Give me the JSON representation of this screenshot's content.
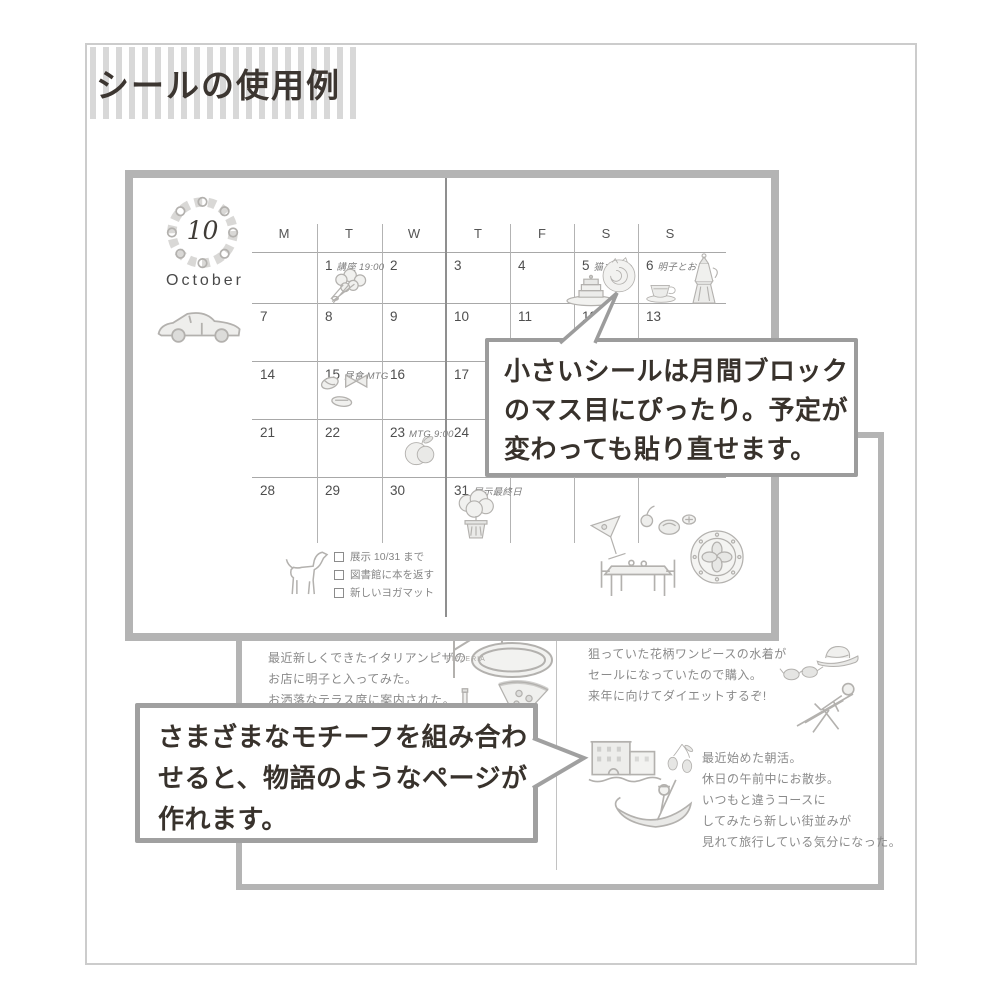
{
  "header": {
    "title": "シールの使用例"
  },
  "calendar": {
    "month_number": "10",
    "month_name": "October",
    "weekdays": [
      "M",
      "T",
      "W",
      "T",
      "F",
      "S",
      "S"
    ],
    "cells": [
      {
        "row": 0,
        "col": 1,
        "num": "1",
        "note": "講座 19:00"
      },
      {
        "row": 0,
        "col": 2,
        "num": "2",
        "note": ""
      },
      {
        "row": 0,
        "col": 3,
        "num": "3",
        "note": ""
      },
      {
        "row": 0,
        "col": 4,
        "num": "4",
        "note": ""
      },
      {
        "row": 0,
        "col": 5,
        "num": "5",
        "note": "猫カフェ"
      },
      {
        "row": 0,
        "col": 6,
        "num": "6",
        "note": "明子とお茶"
      },
      {
        "row": 1,
        "col": 0,
        "num": "7",
        "note": ""
      },
      {
        "row": 1,
        "col": 1,
        "num": "8",
        "note": ""
      },
      {
        "row": 1,
        "col": 2,
        "num": "9",
        "note": ""
      },
      {
        "row": 1,
        "col": 3,
        "num": "10",
        "note": ""
      },
      {
        "row": 1,
        "col": 4,
        "num": "11",
        "note": ""
      },
      {
        "row": 1,
        "col": 5,
        "num": "12",
        "note": ""
      },
      {
        "row": 1,
        "col": 6,
        "num": "13",
        "note": ""
      },
      {
        "row": 2,
        "col": 0,
        "num": "14",
        "note": ""
      },
      {
        "row": 2,
        "col": 1,
        "num": "15",
        "note": "昼食 MTG"
      },
      {
        "row": 2,
        "col": 2,
        "num": "16",
        "note": ""
      },
      {
        "row": 2,
        "col": 3,
        "num": "17",
        "note": ""
      },
      {
        "row": 2,
        "col": 4,
        "num": "18",
        "note": ""
      },
      {
        "row": 2,
        "col": 5,
        "num": "19",
        "note": ""
      },
      {
        "row": 2,
        "col": 6,
        "num": "20",
        "note": ""
      },
      {
        "row": 3,
        "col": 0,
        "num": "21",
        "note": ""
      },
      {
        "row": 3,
        "col": 1,
        "num": "22",
        "note": ""
      },
      {
        "row": 3,
        "col": 2,
        "num": "23",
        "note": "MTG 9:00"
      },
      {
        "row": 3,
        "col": 3,
        "num": "24",
        "note": ""
      },
      {
        "row": 3,
        "col": 4,
        "num": "25",
        "note": ""
      },
      {
        "row": 3,
        "col": 5,
        "num": "26",
        "note": ""
      },
      {
        "row": 3,
        "col": 6,
        "num": "27",
        "note": ""
      },
      {
        "row": 4,
        "col": 0,
        "num": "28",
        "note": ""
      },
      {
        "row": 4,
        "col": 1,
        "num": "29",
        "note": ""
      },
      {
        "row": 4,
        "col": 2,
        "num": "30",
        "note": ""
      },
      {
        "row": 4,
        "col": 3,
        "num": "31",
        "note": "展示最終日"
      }
    ],
    "checklist": [
      "展示 10/31 まで",
      "図書館に本を返す",
      "新しいヨガマット"
    ]
  },
  "bubbles": {
    "small": {
      "lines": [
        "小さいシールは月間ブロック",
        "のマス目にぴったり。予定が",
        "変わっても貼り直せます。"
      ]
    },
    "motif": {
      "lines": [
        "さまざまなモチーフを組み合わ",
        "せると、物語のようなページが",
        "作れます。"
      ]
    }
  },
  "spread": {
    "left_note": {
      "lines": [
        "最近新しくできたイタリアンピザの",
        "お店に明子と入ってみた。",
        "お洒落なテラス席に案内された。"
      ]
    },
    "right_note1": {
      "lines": [
        "狙っていた花柄ワンピースの水着が",
        "セールになっていたので購入。",
        "来年に向けてダイエットするぞ!"
      ]
    },
    "right_note2": {
      "lines": [
        "最近始めた朝活。",
        "休日の午前中にお散歩。",
        "いつもと違うコースに",
        "してみたら新しい街並みが",
        "見れて旅行している気分になった。"
      ]
    },
    "pizzeria_sign_label": "PIZZERIA"
  },
  "stickers": [
    "flower-wreath",
    "sports-car",
    "flower-bouquet",
    "layer-cake",
    "cat-latte",
    "espresso-cup",
    "moka-pot",
    "pasta",
    "fruit",
    "potted-plant",
    "dog",
    "cocktail-glass",
    "small-fruits",
    "cafe-table",
    "decorative-plate",
    "pizzeria-sign",
    "pizza-slice",
    "wine-bottle-and-glass",
    "sunglasses",
    "straw-hat",
    "sunbathing-person",
    "venice-buildings",
    "olives",
    "gondola"
  ],
  "colors": {
    "panel_border": "#b4b4b4",
    "bubble_border": "#9c9c9c",
    "text_dark": "#3a342f",
    "handwriting_gray": "#8a8a8a",
    "sticker_gray": "#b3b1ae"
  }
}
